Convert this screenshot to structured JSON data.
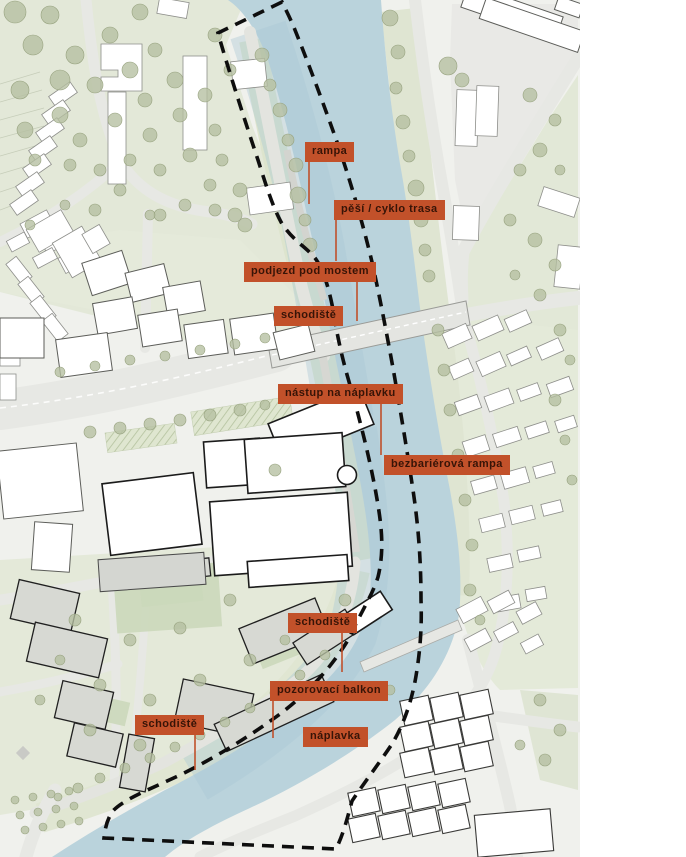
{
  "annotations": {
    "labels": [
      {
        "id": "rampa",
        "text": "rampa"
      },
      {
        "id": "pesi-cyklo-trasa",
        "text": "pěší / cyklo trasa"
      },
      {
        "id": "podjezd-pod-mostem",
        "text": "podjezd pod mostem"
      },
      {
        "id": "schodiste-u-mostu",
        "text": "schodiště"
      },
      {
        "id": "nastup-na-naplavku",
        "text": "nástup na náplavku"
      },
      {
        "id": "bezbarierova-rampa",
        "text": "bezbariérová rampa"
      },
      {
        "id": "schodiste-vychod",
        "text": "schodiště"
      },
      {
        "id": "pozorovaci-balkon",
        "text": "pozorovací balkon"
      },
      {
        "id": "schodiste-zapad",
        "text": "schodiště"
      },
      {
        "id": "naplavka",
        "text": "náplavka"
      }
    ],
    "colors": {
      "label_bg": "#c2512a",
      "label_text": "#371407",
      "leader_line": "#c0502b",
      "river": "#bad3dc",
      "greenery": "#e3e8d8",
      "road": "#e7e8e4",
      "proposed_building": "#d7d9d3",
      "boundary": "#0e0e0e"
    }
  }
}
